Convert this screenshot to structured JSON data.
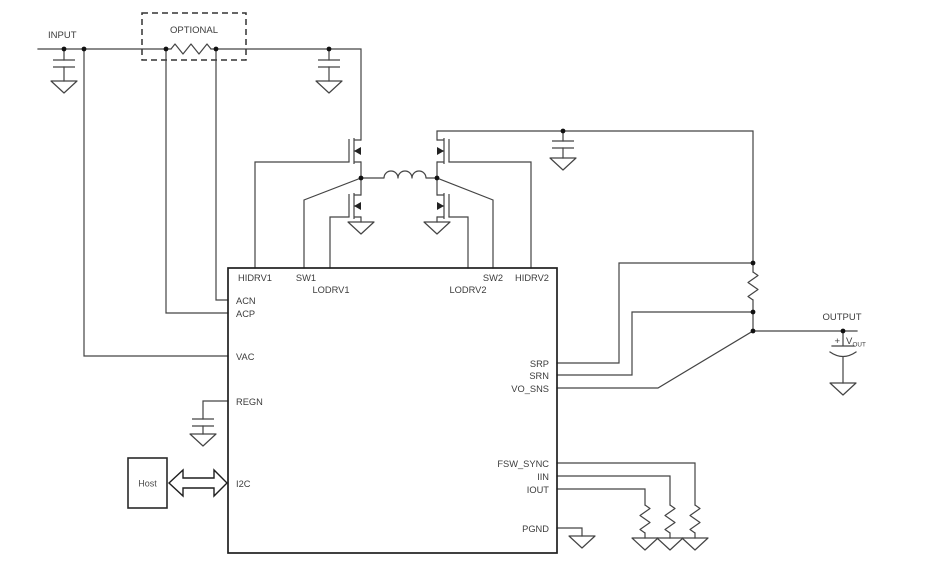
{
  "colors": {
    "background": "#ffffff",
    "wire": "#444444",
    "outline": "#1f1f1f",
    "text": "#3c3c3c",
    "node_dot": "#111111"
  },
  "labels": {
    "input": "INPUT",
    "optional": "OPTIONAL",
    "output": "OUTPUT",
    "host": "Host",
    "plus": "+",
    "vout_main": "V",
    "vout_sub": "OUT"
  },
  "ic": {
    "pins": {
      "hidrv1": "HIDRV1",
      "sw1": "SW1",
      "lodrv1": "LODRV1",
      "lodrv2": "LODRV2",
      "sw2": "SW2",
      "hidrv2": "HIDRV2",
      "acn": "ACN",
      "acp": "ACP",
      "vac": "VAC",
      "regn": "REGN",
      "i2c": "I2C",
      "srp": "SRP",
      "srn": "SRN",
      "vo_sns": "VO_SNS",
      "fsw_sync": "FSW_SYNC",
      "iin": "IIN",
      "iout": "IOUT",
      "pgnd": "PGND"
    }
  },
  "components": {
    "mosfet_count": 4,
    "capacitor_count": 5,
    "resistor_count": 5,
    "inductor_count": 1,
    "ground_symbol_count": 11
  }
}
